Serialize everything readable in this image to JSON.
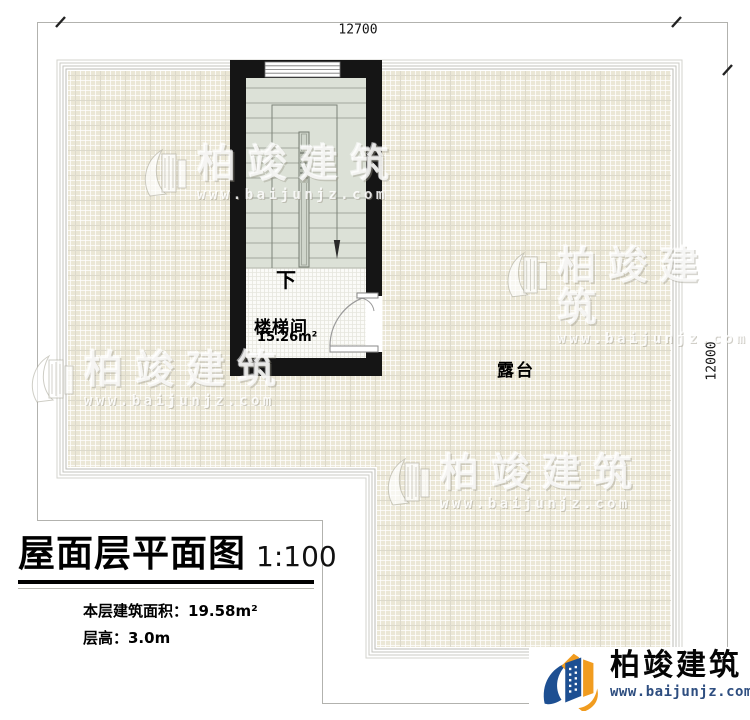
{
  "plan": {
    "dim_top": "12700",
    "dim_right": "12000",
    "down_label": "下",
    "stairwell_label": "楼梯间",
    "stairwell_area": "15.26m²",
    "terrace_label": "露台"
  },
  "title_block": {
    "title": "屋面层平面图",
    "scale": "1:100",
    "area_text": "本层建筑面积：19.58m²",
    "floor_height_text": "层高：3.0m"
  },
  "watermark": {
    "brand": "柏竣建筑",
    "site": "www.baijunjz.com"
  },
  "footer_logo": {
    "brand": "柏竣建筑",
    "site": "www.baijunjz.com"
  },
  "colors": {
    "wall": "#151515",
    "tile_base": "#ebe7d6",
    "stair_fill": "#dce1d7",
    "logo_blue": "#1d4f92",
    "logo_orange": "#f19c1f"
  }
}
